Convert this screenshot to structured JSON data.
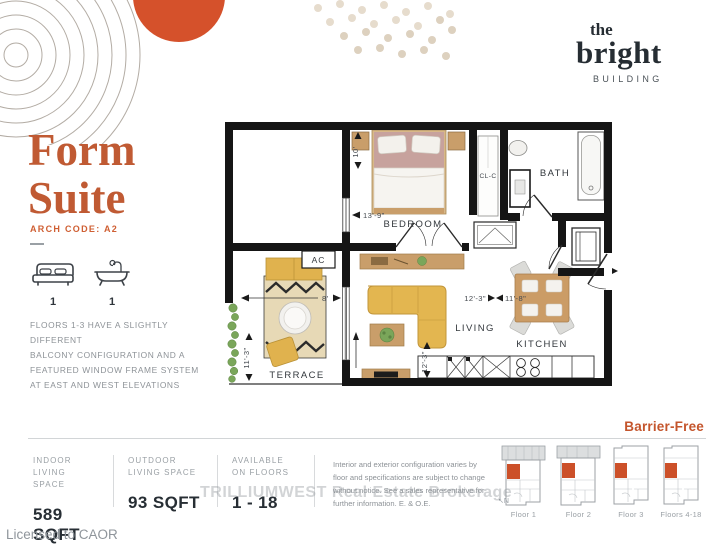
{
  "logo": {
    "the": "the",
    "name": "bright",
    "building": "BUILDING"
  },
  "suite": {
    "title_line1": "Form",
    "title_line2": "Suite",
    "arch_code": "ARCH CODE: A2",
    "bed_count": "1",
    "bath_count": "1",
    "note_lines": [
      "FLOORS 1-3 HAVE A SLIGHTLY DIFFERENT",
      "BALCONY CONFIGURATION AND A",
      "FEATURED WINDOW FRAME SYSTEM",
      "AT EAST AND WEST ELEVATIONS"
    ]
  },
  "plan": {
    "labels": {
      "bedroom": "BEDROOM",
      "closet": "CL-C",
      "bath": "BATH",
      "living": "LIVING",
      "kitchen": "KITCHEN",
      "terrace": "TERRACE",
      "ac": "AC"
    },
    "dimensions": {
      "bedroom_width": "10'",
      "bedroom_length": "13'-9\"",
      "terrace_width": "8'",
      "terrace_length": "11'-3\"",
      "living_width_a": "12'-3\"",
      "living_width_b": "11'-8\"",
      "living_length": "12'-3\""
    }
  },
  "footer": {
    "barrier_free": "Barrier-Free",
    "stats": [
      {
        "label_line1": "INDOOR",
        "label_line2": "LIVING SPACE",
        "value": "589 SQFT"
      },
      {
        "label_line1": "OUTDOOR",
        "label_line2": "LIVING SPACE",
        "value": "93 SQFT"
      },
      {
        "label_line1": "AVAILABLE",
        "label_line2": "ON FLOORS",
        "value": "1 - 18"
      }
    ],
    "disclaimer_lines": [
      "Interior and exterior configuration varies by",
      "floor and specifications are subject to change",
      "without notice. See a sales representative for",
      "further information. E. & O.E."
    ],
    "floor_keys": [
      "Floor 1",
      "Floor 2",
      "Floor 3",
      "Floors 4-18"
    ],
    "compass": "N"
  },
  "watermark": "TRILLIUMWEST Real Estate Brokerage",
  "licensed": "Licensed to CAOR",
  "colors": {
    "accent": "#cf512b",
    "ink": "#2b3137",
    "muted": "#8d9297",
    "wall": "#151515",
    "wood": "#c99e6a",
    "sofa": "#e3b650"
  }
}
